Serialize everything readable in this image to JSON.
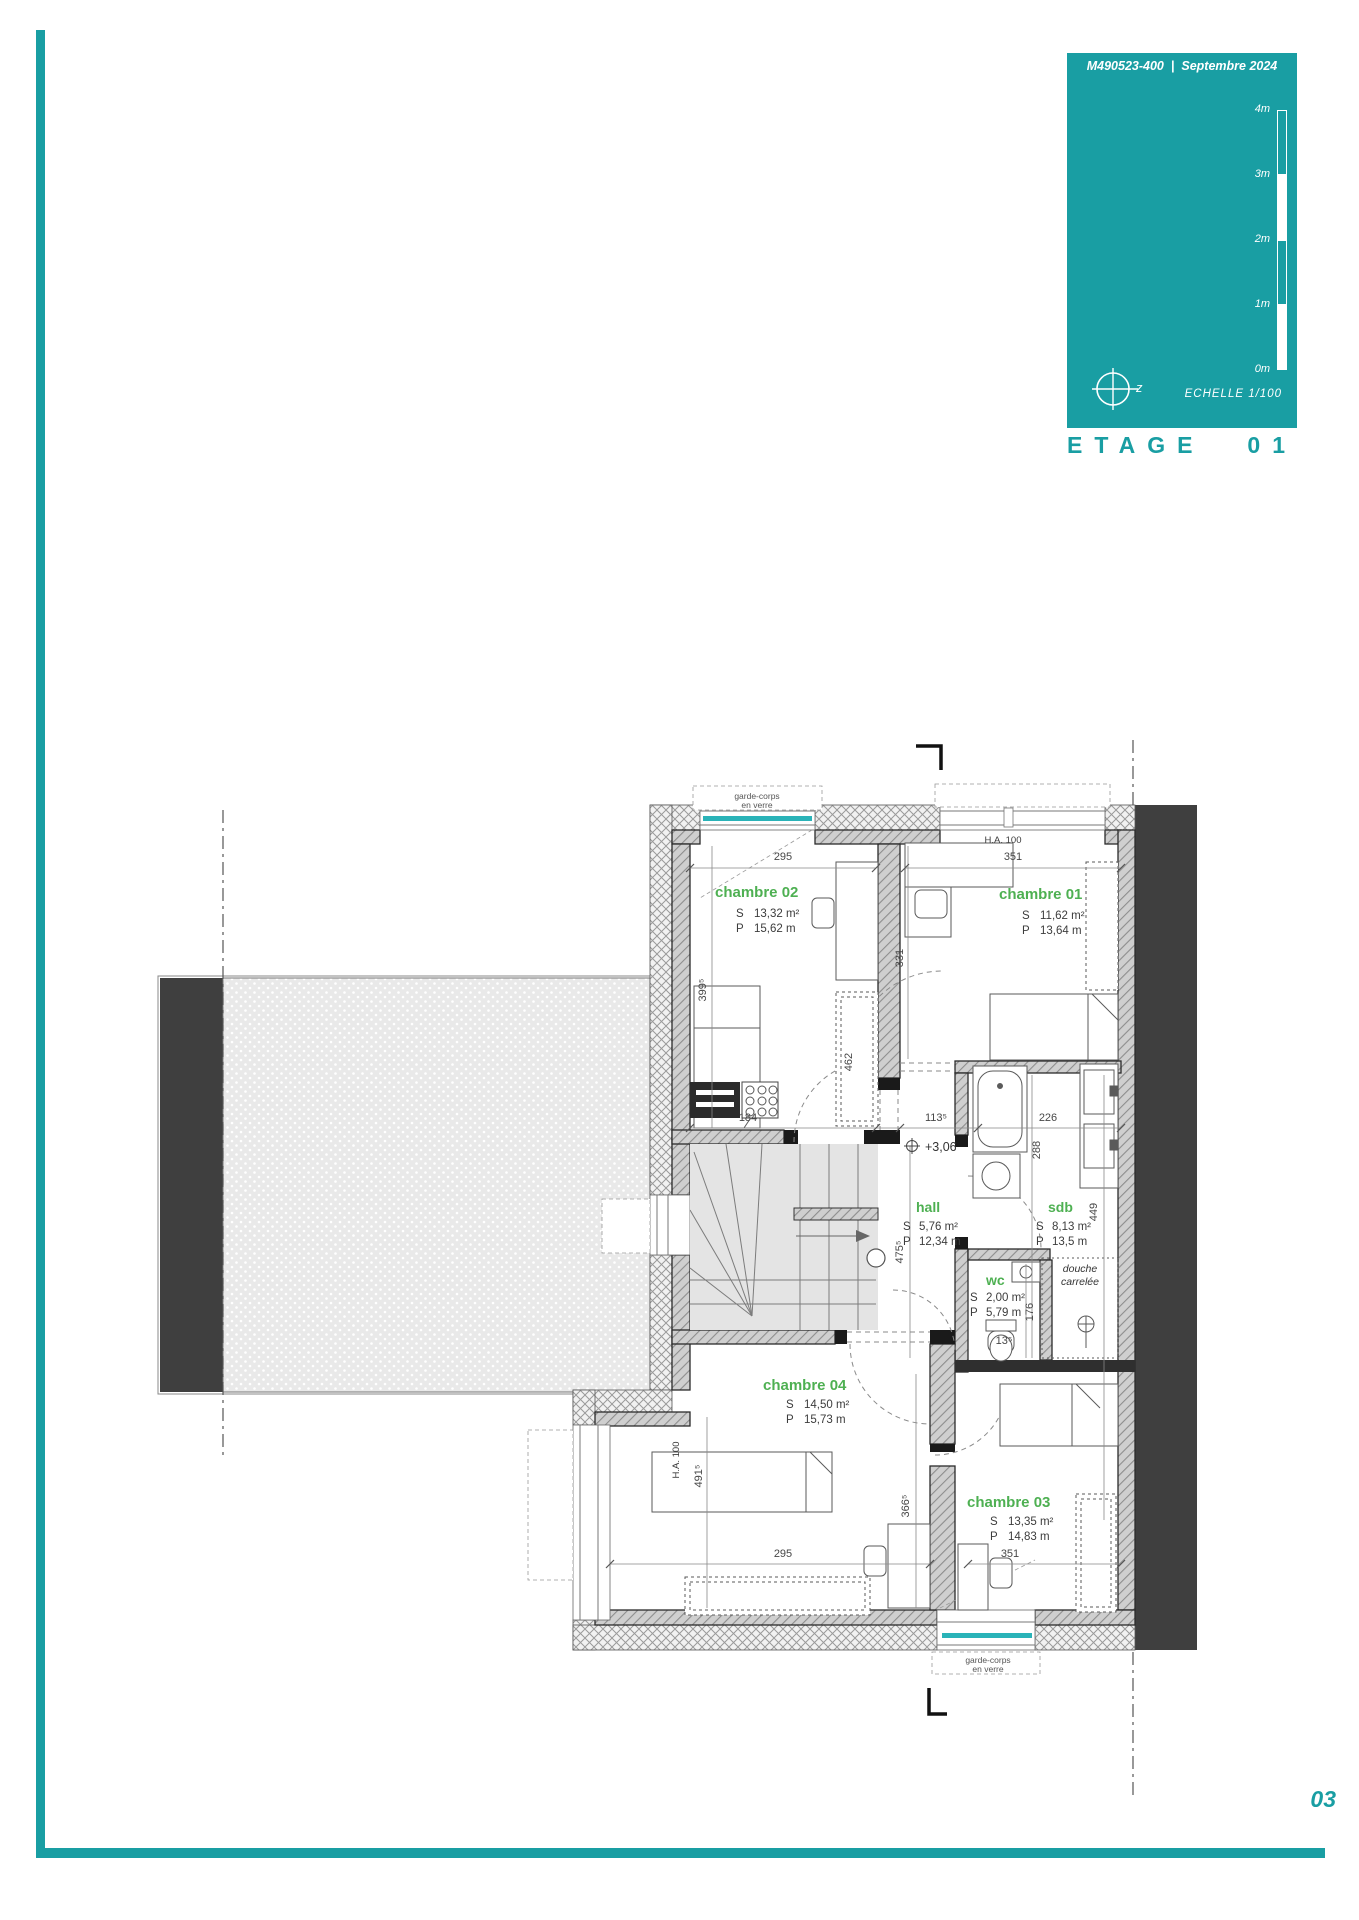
{
  "header": {
    "doc_ref": "M490523-400",
    "divider": "|",
    "date": "Septembre 2024",
    "scale_ticks": [
      "4m",
      "3m",
      "2m",
      "1m",
      "0m"
    ],
    "compass_label": "z",
    "echelle_label": "ECHELLE  1/100",
    "floor_title": "ETAGE",
    "floor_number": "01"
  },
  "footer": {
    "page_number": "03"
  },
  "colors": {
    "teal": "#199EA3",
    "green": "#4EB052",
    "dark_gray": "#3F3F3F",
    "glass_teal": "#2AB3B8"
  },
  "plan": {
    "rooms": {
      "ch02": {
        "name": "chambre 02",
        "s": "S",
        "area": "13,32 m²",
        "p": "P",
        "perimeter": "15,62 m"
      },
      "ch01": {
        "name": "chambre 01",
        "s": "S",
        "area": "11,62 m²",
        "p": "P",
        "perimeter": "13,64 m"
      },
      "ch03": {
        "name": "chambre 03",
        "s": "S",
        "area": "13,35 m²",
        "p": "P",
        "perimeter": "14,83 m"
      },
      "ch04": {
        "name": "chambre 04",
        "s": "S",
        "area": "14,50 m²",
        "p": "P",
        "perimeter": "15,73 m"
      },
      "hall": {
        "name": "hall",
        "s": "S",
        "area": "5,76 m²",
        "p": "P",
        "perimeter": "12,34 m"
      },
      "sdb": {
        "name": "sdb",
        "s": "S",
        "area": "8,13 m²",
        "p": "P",
        "perimeter": "13,5 m"
      },
      "wc": {
        "name": "wc",
        "s": "S",
        "area": "2,00 m²",
        "p": "P",
        "perimeter": "5,79 m"
      }
    },
    "annotations": {
      "douche_1": "douche",
      "douche_2": "carrelée",
      "garde_corps_1": "garde-corps",
      "garde_corps_2": "en verre",
      "level": "+3,06",
      "ha100": "H.A.  100"
    },
    "dims": {
      "w_ch02": "295",
      "w_ch01": "351",
      "h_ch02": "399⁵",
      "h_ch01": "331",
      "wardrobe": "462",
      "d184": "184",
      "d113": "113⁵",
      "d226": "226",
      "d288": "288",
      "d449": "449",
      "d176": "176",
      "d13": "13⁵",
      "h_hall": "475⁵",
      "h_ch04": "491⁵",
      "h_ch03": "366⁵",
      "w_ch04": "295",
      "w_ch03": "351"
    }
  }
}
